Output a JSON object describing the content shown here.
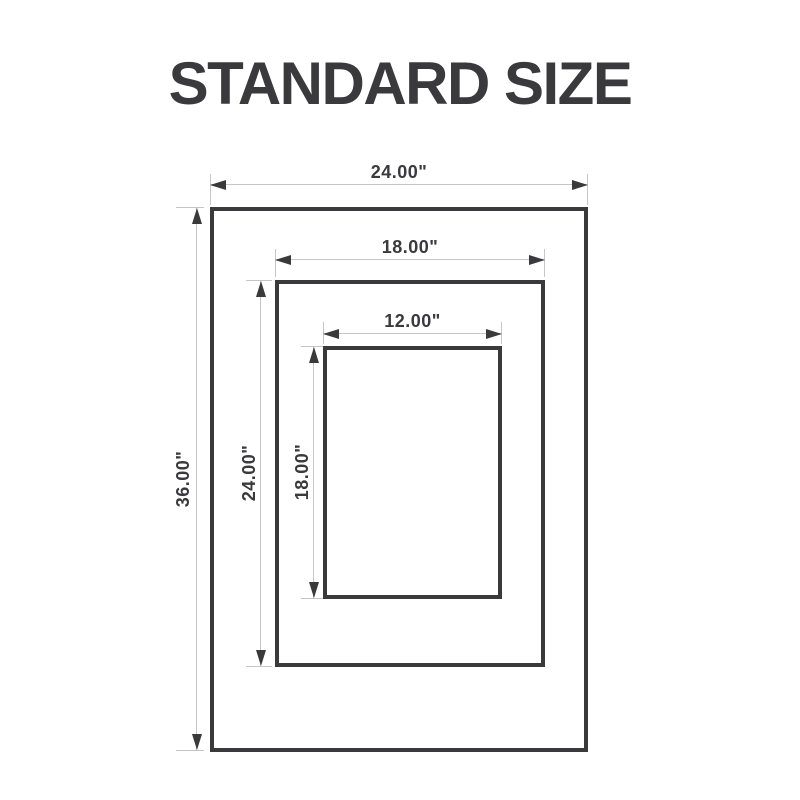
{
  "title": "STANDARD SIZE",
  "colors": {
    "ink": "#3a3a3c",
    "dim_line": "#c6c6c6",
    "background": "#ffffff"
  },
  "diagram": {
    "sizes": [
      {
        "id": "outer",
        "width": "24.00\"",
        "height": "36.00\""
      },
      {
        "id": "middle",
        "width": "18.00\"",
        "height": "24.00\""
      },
      {
        "id": "inner",
        "width": "12.00\"",
        "height": "18.00\""
      }
    ]
  }
}
